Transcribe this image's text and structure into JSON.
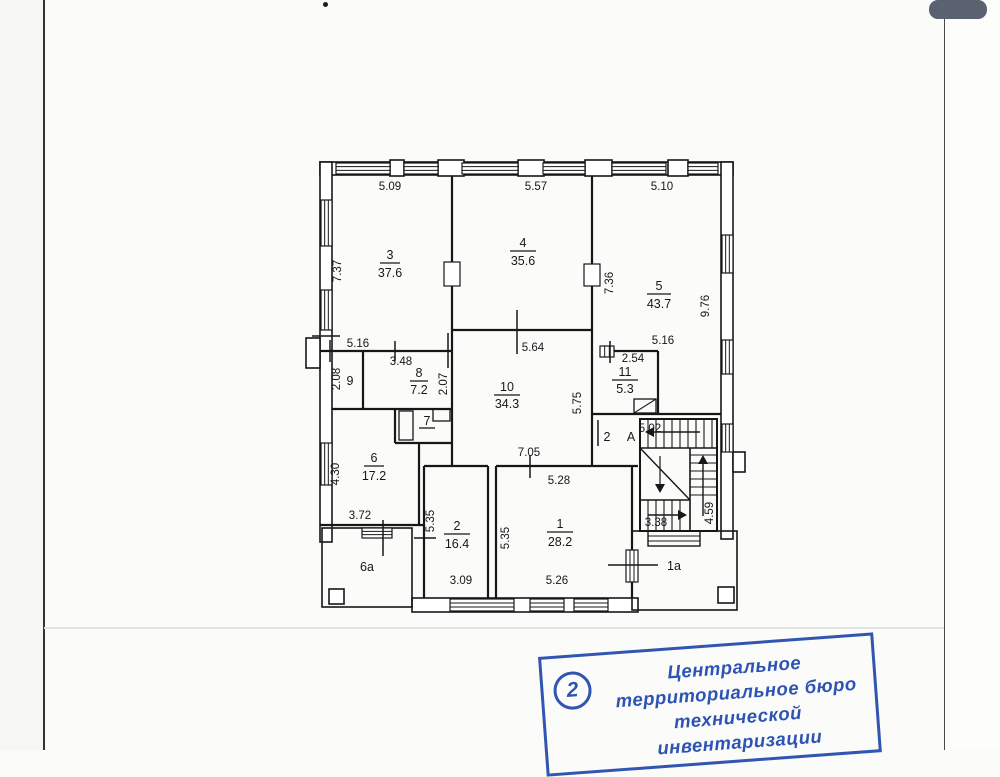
{
  "colors": {
    "ink": "#171717",
    "stamp_blue": "#2d54b4",
    "page_background": "#fbfbfa",
    "corner_tab_gray": "#5a6170"
  },
  "plan": {
    "rooms": [
      {
        "number": "3",
        "area": "37.6"
      },
      {
        "number": "4",
        "area": "35.6"
      },
      {
        "number": "5",
        "area": "43.7"
      },
      {
        "number": "9",
        "area": ""
      },
      {
        "number": "8",
        "area": "7.2"
      },
      {
        "number": "10",
        "area": "34.3"
      },
      {
        "number": "11",
        "area": "5.3"
      },
      {
        "number": "7",
        "area": ""
      },
      {
        "number": "6",
        "area": "17.2"
      },
      {
        "number": "2",
        "area": ""
      },
      {
        "number": "А",
        "area": ""
      },
      {
        "number": "2",
        "area": "16.4"
      },
      {
        "number": "1",
        "area": "28.2"
      },
      {
        "number": "6а",
        "area": ""
      },
      {
        "number": "1а",
        "area": ""
      }
    ],
    "dims": [
      "5.09",
      "5.57",
      "5.10",
      "7.37",
      "7.36",
      "9.76",
      "5.16",
      "5.16",
      "3.48",
      "2.08",
      "2.07",
      "5.64",
      "5.75",
      "2.54",
      "5.02",
      "7.05",
      "4.30",
      "3.72",
      "5.35",
      "5.35",
      "5.28",
      "3.09",
      "5.26",
      "3.38",
      "4.59"
    ]
  },
  "stamp": {
    "number": "2",
    "lines": [
      "Центральное",
      "территориальное бюро",
      "технической инвентаризации"
    ]
  }
}
